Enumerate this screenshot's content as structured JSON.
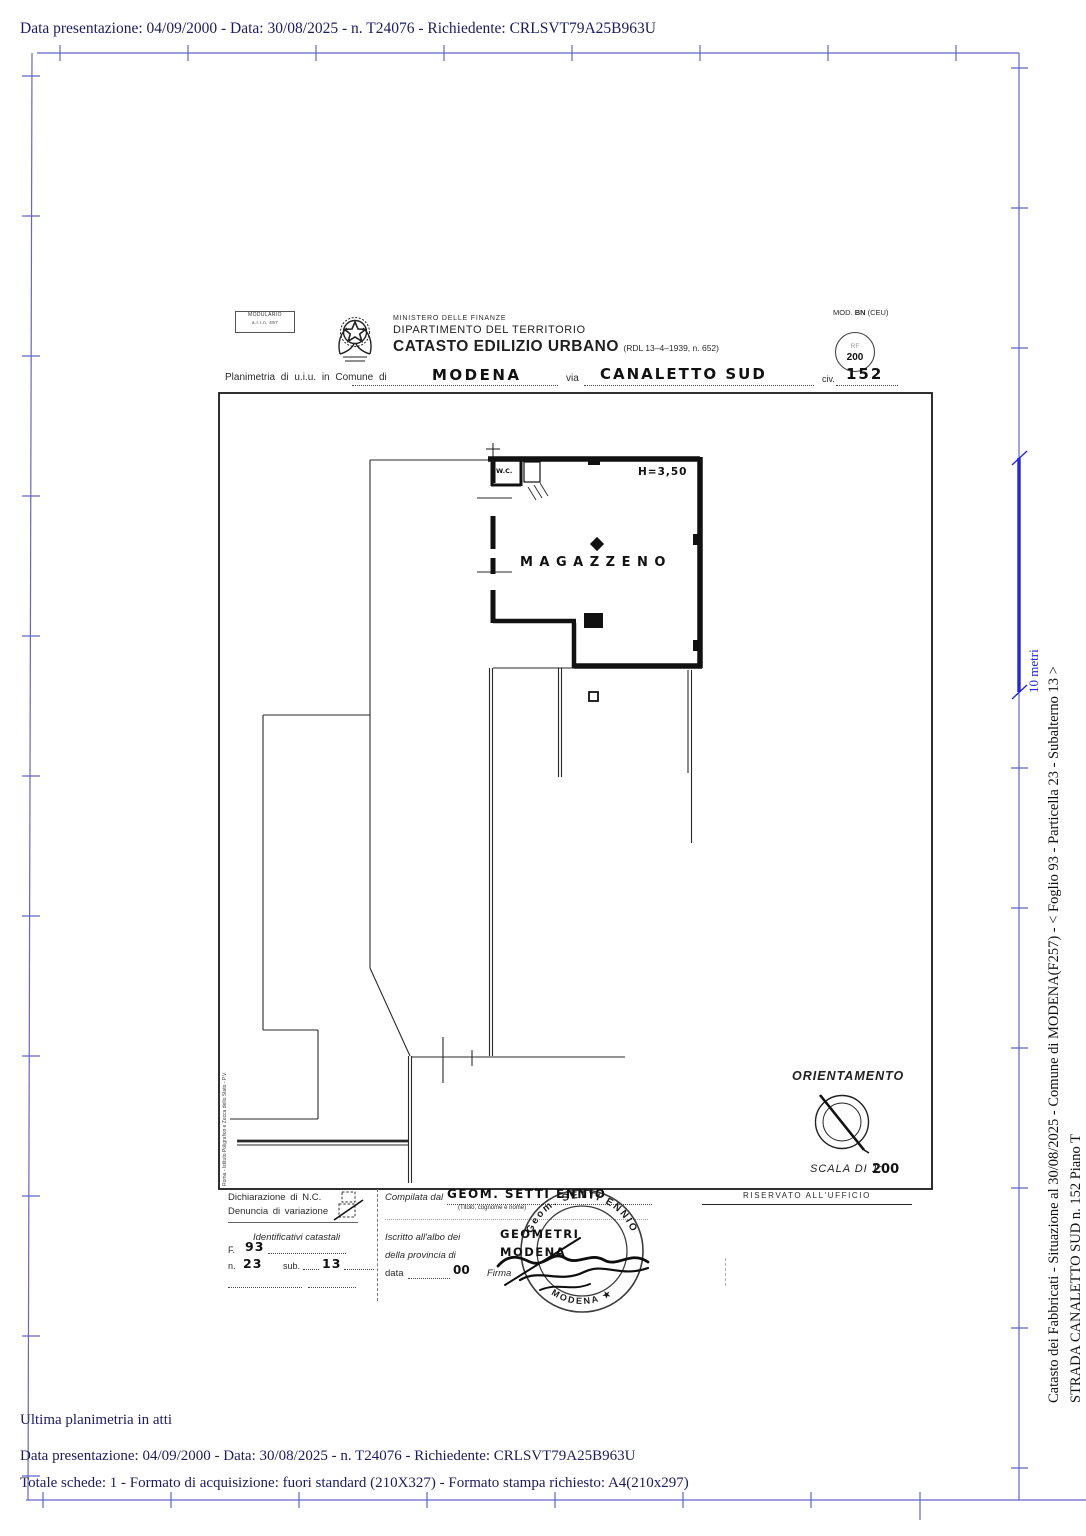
{
  "page": {
    "top_line": "Data presentazione: 04/09/2000 - Data: 30/08/2025 - n. T24076 - Richiedente: CRLSVT79A25B963U",
    "bottom": {
      "line1": "Ultima planimetria in atti",
      "line2": "Data presentazione: 04/09/2000 - Data: 30/08/2025 - n. T24076 - Richiedente: CRLSVT79A25B963U",
      "line3": "Totale schede: 1 - Formato di acquisizione: fuori standard (210X327) - Formato stampa richiesto: A4(210x297)"
    },
    "side": {
      "ruler_label": "10 metri",
      "caption1": "Catasto dei Fabbricati - Situazione al 30/08/2025 - Comune di MODENA(F257) - <  Foglio 93 - Particella  23 - Subalterno 13 >",
      "caption2": "STRADA CANALETTO SUD n. 152 Piano T"
    }
  },
  "header": {
    "modulario_line1": "MODULARIO",
    "modulario_line2": "a.r.r.n. 497",
    "ministero": "MINISTERO DELLE FINANZE",
    "dipartimento": "DIPARTIMENTO DEL TERRITORIO",
    "catasto": "CATASTO EDILIZIO URBANO",
    "rdl": "(RDL 13–4–1939, n. 652)",
    "mod_prefix": "MOD.",
    "mod_bn": "BN",
    "mod_suffix": "(CEU)",
    "rf_top": "RF",
    "rf_value": "200",
    "plan_label1": "Planimetria di u.i.u. in Comune di",
    "comune_value": "MODENA",
    "plan_label2": "via",
    "via_value": "CANALETTO SUD",
    "plan_label3": "civ.",
    "civ_value": "152"
  },
  "plan": {
    "room_label": "MAGAZZENO",
    "wc_label": "W.C.",
    "height_label": "H=3,50",
    "orientamento": "ORIENTAMENTO",
    "scala_label": "SCALA DI 1:",
    "scala_value": "200",
    "print_credit": "Roma - Istituto Poligrafico e Zecca dello Stato - P.V."
  },
  "form": {
    "dichiarazione": "Dichiarazione di N.C.",
    "denuncia": "Denuncia di variazione",
    "identificativi": "Identificativi catastali",
    "f_label": "F.",
    "f_value": "93",
    "n_label": "n.",
    "n_value": "23",
    "sub_label": "sub.",
    "sub_value": "13",
    "compilata_label": "Compilata dal",
    "compilata_value": "GEOM. SETTI ENNIO",
    "titolo_note": "(Titolo, cognome e nome)",
    "iscritto_label": "Iscritto all'albo dei",
    "iscritto_value": "GEOMETRI",
    "provincia_label": "della provincia di",
    "provincia_value": "MODENA",
    "data_label": "data",
    "data_value": "00",
    "firma_label": "Firma",
    "riservato": "RISERVATO ALL'UFFICIO",
    "stamp_top": "Geom.  SETTI  ENNIO",
    "stamp_bottom": "MODENA  ★"
  },
  "colors": {
    "frame_blue": "#6565c5",
    "ruler_blue": "#2626d8",
    "text_navy": "#1c1c5e",
    "ink": "#1f1f1f"
  }
}
